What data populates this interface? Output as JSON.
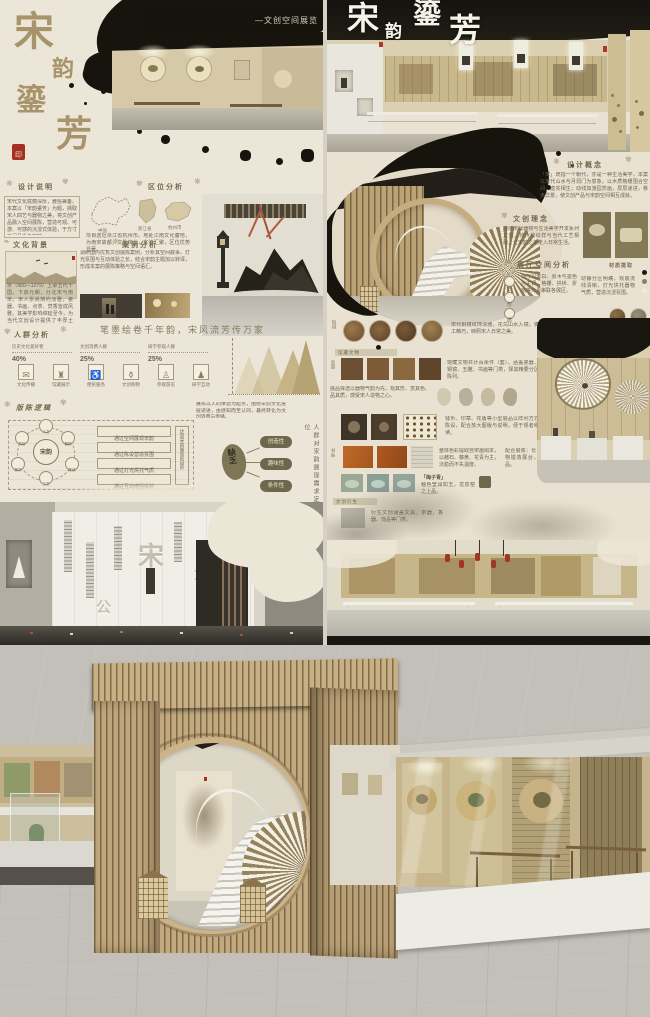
{
  "palette": {
    "ink": "#17140e",
    "parchment": "#ece6d8",
    "gold": "#a8946a",
    "seal_red": "#a53125",
    "olive": "#6d684c",
    "wood": "#bba376"
  },
  "orn": {
    "a": "❋",
    "b": "✾",
    "c": "❧"
  },
  "left": {
    "title_chars": [
      "宋",
      "韵",
      "鎏",
      "芳"
    ],
    "seal_char": "印",
    "banner": "—文创空间展览",
    "design": {
      "header": "设计说明",
      "body": "宋代文化底蕴深厚，雅俗兼备。本案以「宋韵鎏芳」为题，撷取宋人四艺与器物之美，将文创产品融入空间展陈，营造可观、可游、可感的沉浸式体验，于方寸之间品千年宋韵。"
    },
    "location": {
      "header": "区位分析",
      "cap1": "中国",
      "cap2": "浙江省",
      "cap3": "杭州市",
      "body": "项目选址浙江省杭州市。地处江南文化腹地，为南宋故都，文脉绵长，客流汇聚，区位优势显著。"
    },
    "culture": {
      "header": "文化背景",
      "body": "宋（960—1279）上承五代十国，下启元朝，分北宋与南宋。宋人崇尚简约淡雅，瓷器、书画、点茶、焚香皆成风雅。其美学影响绵延至今，为当代文创设计提供了丰厚土壤，亦是本案立意之根基。"
    },
    "case": {
      "header": "案例分析",
      "body": "调研国内优秀文创展陈案例，分析其空间叙事、灯光氛围与互动体验之长，结合宋韵主题加以转译，形成本案的展陈策略与空间语汇。"
    },
    "audience": {
      "header": "人群分析",
      "quote": "笔墨绘卷千年韵，宋风流芳传万家",
      "stats": [
        {
          "label": "历史文化爱好者",
          "value": "40%"
        },
        {
          "label": "文创消费人群",
          "value": "25%"
        },
        {
          "label": "研学参观人群",
          "value": "25%"
        }
      ],
      "icons": [
        {
          "glyph": "✉",
          "label": "文化传播"
        },
        {
          "glyph": "♜",
          "label": "馆藏展示"
        },
        {
          "glyph": "♿",
          "label": "便民服务"
        },
        {
          "glyph": "⚱",
          "label": "文创购物"
        },
        {
          "glyph": "♙",
          "label": "参观游览"
        },
        {
          "glyph": "♟",
          "label": "研学互动"
        }
      ]
    },
    "logic": {
      "header": "版陈逻辑",
      "note": "展陈以人的体验为起点，围绕宋韵文化层层递进，由感知而至认同，最终转化为文创消费与传播。",
      "center": "宋韵",
      "satellites": [
        "人文",
        "风俗",
        "器物",
        "美学",
        "陈设",
        "工艺"
      ],
      "bars": [
        "通过空间展现宋韵",
        "通过陈设营造氛围",
        "通过灯光烘托气质",
        "通过互动增强体验"
      ],
      "result": "达到宋韵展现的目的",
      "lack": "缺乏",
      "pills": [
        "创造性",
        "趣味性",
        "条件性"
      ],
      "vertical_note": "人群对宋韵展现需求定位"
    }
  },
  "right": {
    "title_chars": [
      "宋",
      "韵",
      "鎏",
      "芳"
    ],
    "concept": {
      "header": "设计概念",
      "body": "「宋」既指一个朝代，亦是一种生活美学。本案以宋代山水与月洞门为意象，以木质格栅围合空间，虚实相生；动线如游园赏画，层层递进，移步异景，使文创产品与宋韵空间相互成就。"
    },
    "idea": {
      "header": "文创理念",
      "body": "围绕宋代器物与生活美学开发系列文创，将传统纹样与当代工艺相融，让宋韵之美走入日常生活。"
    },
    "space": {
      "header": "展厅空间分析",
      "keys": [
        "色",
        "形",
        "质"
      ],
      "body1": "展厅以米白、原木与墨色为主调，格栅、拱桥、折扇等元素串联各展区。",
      "body2": "动静分区明确，观展流线清晰，灯光烘托器物气质，营造沉浸氛围。"
    },
    "materials": {
      "header": "材质提取",
      "swatch1": "原木纹理",
      "swatch2": "夯土肌理"
    },
    "rows": {
      "a": {
        "tag": "铜镜",
        "body": "宋代铜镜纹饰清雅，花鸟山水入镜，铸工精巧，映照宋人日常之美。"
      },
      "b": {
        "strip": "馆藏文物",
        "tag": "瓷器",
        "body": "馆藏文物共计百余件（套），涵盖瓷器、铜镜、玉雕、书画等门类，择其精要分区陈列。",
        "body2": "展品择选以器物气韵为先，观其形、赏其色、品其质，感受宋人造物之心。"
      },
      "c": {
        "body": "钱币、印章、花版等小型展品以阵列方式陈设，配合放大图版与说明，便于观者细读。"
      },
      "d": {
        "tag": "书画",
        "body": "整体色彩提取自宋画绢本，以赭石、藤黄、花青为主，沉稳而不失温度。"
      },
      "e": {
        "label": "「梅子青」",
        "body": "釉色莹润如玉，龙泉窑之上品。",
        "note": "配合展陈：长卷横陈展墙，器物错落展台，观者可近赏细品。"
      },
      "f": {
        "strip": "文创衍生",
        "body": "衍生文创涵盖文具、茶器、香器、饰品等门类。"
      }
    }
  }
}
